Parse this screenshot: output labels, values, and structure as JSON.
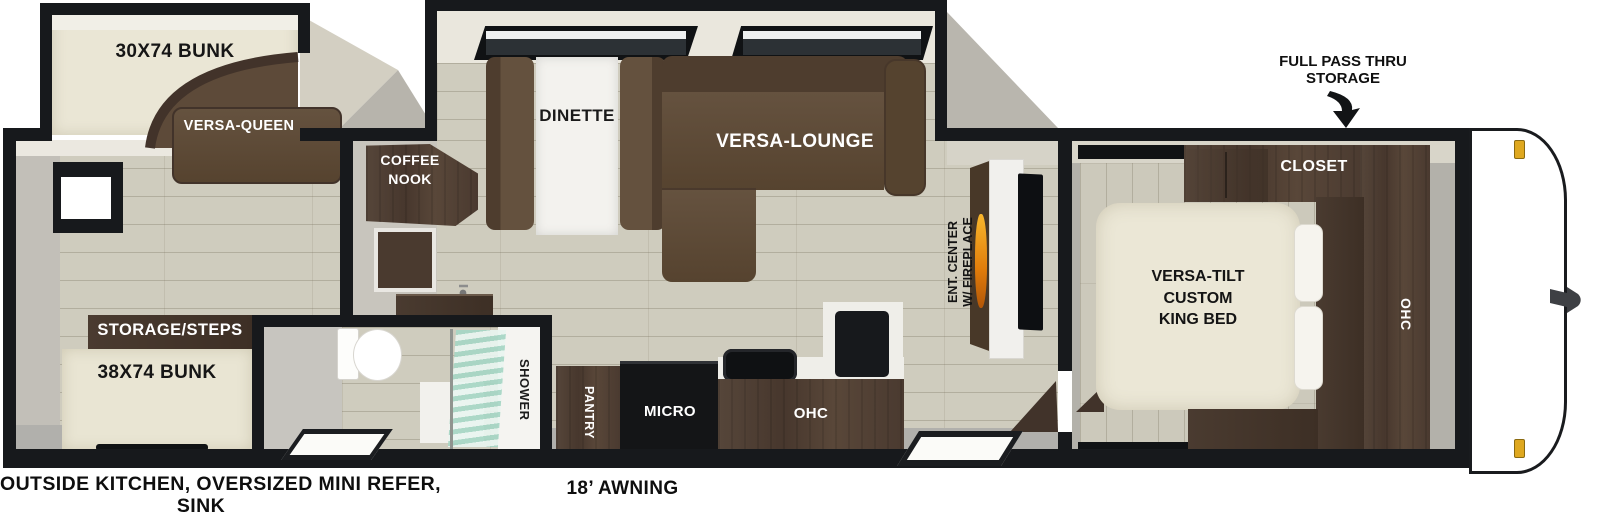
{
  "diagram_title": "RV travel trailer floor plan",
  "colors": {
    "wall_black": "#17191c",
    "wood_floor": "#cfccbe",
    "walnut_cabinet": "#4c3c31",
    "sofa_brown": "#5d4a39",
    "bed_cream": "#e9e5d3",
    "shower_glass_teal": "#a6d6c4",
    "flame_orange": "#f09a1c",
    "clearance_light_gold": "#dfa81f",
    "floor_gray": "#b1b0ac"
  },
  "bunk_slide": {
    "bunk_label": "30X74 BUNK",
    "sofa_label": "VERSA-QUEEN"
  },
  "slide_out": {
    "dinette_label": "DINETTE",
    "lounge_label": "VERSA-LOUNGE"
  },
  "galley": {
    "coffee_nook_line1": "COFFEE",
    "coffee_nook_line2": "NOOK",
    "pantry_label": "PANTRY",
    "micro_label": "MICRO",
    "ohc_label": "OHC"
  },
  "rear_room": {
    "storage_label": "STORAGE/STEPS",
    "bunk_label": "38X74 BUNK"
  },
  "bathroom": {
    "shower_label": "SHOWER"
  },
  "living": {
    "ent_center_line1": "ENT. CENTER",
    "ent_center_line2": "W/ FIREPLACE"
  },
  "bedroom": {
    "bed_line1": "VERSA-TILT",
    "bed_line2": "CUSTOM",
    "bed_line3": "KING BED",
    "closet_label": "CLOSET",
    "ohc_label": "OHC"
  },
  "annotations": {
    "pass_thru_line1": "FULL PASS THRU",
    "pass_thru_line2": "STORAGE",
    "awning_label": "18’ AWNING",
    "outside_kitchen_line1": "OUTSIDE KITCHEN, OVERSIZED MINI REFER,",
    "outside_kitchen_line2": "SINK"
  }
}
